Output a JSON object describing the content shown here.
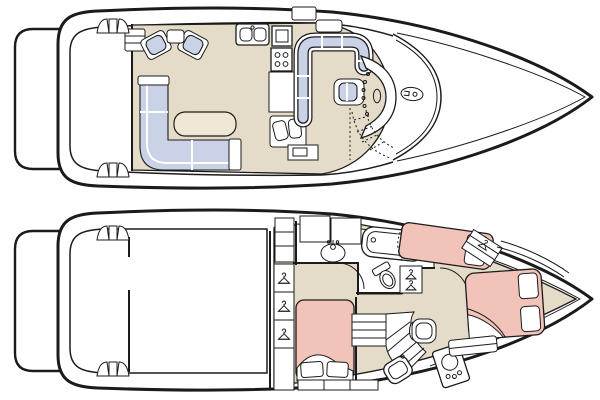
{
  "title": "Motor yacht two-deck floor plan",
  "colors": {
    "line": "#1b1b1b",
    "floor": "#e4dcc8",
    "cushion": "#c9d2e6",
    "bed": "#f2c3b9",
    "table": "#efe8d6",
    "paper": "#ffffff"
  },
  "decks": [
    {
      "label": "Main deck",
      "areas": [
        {
          "name": "swim-platform",
          "fixtures": []
        },
        {
          "name": "aft-cockpit",
          "fixtures": [
            "boarding-steps-port",
            "boarding-steps-starboard",
            "salon-entry-steps"
          ]
        },
        {
          "name": "salon",
          "fixtures": [
            "armchair-port",
            "armchair-starboard",
            "side-table",
            "l-shaped-sofa",
            "coffee-table",
            "bench-seat",
            "tv-cabinet"
          ]
        },
        {
          "name": "galley",
          "fixtures": [
            "double-sink",
            "refrigerator",
            "four-burner-stove",
            "counter"
          ]
        },
        {
          "name": "dinette",
          "fixtures": [
            "wraparound-booth",
            "deck-hatch"
          ]
        },
        {
          "name": "helm",
          "fixtures": [
            "helm-seat",
            "instrument-console",
            "steering-wheel",
            "windshield",
            "companionway-stairs",
            "foredeck-hatch"
          ]
        }
      ]
    },
    {
      "label": "Lower deck",
      "areas": [
        {
          "name": "swim-platform",
          "fixtures": []
        },
        {
          "name": "cockpit",
          "fixtures": [
            "boarding-steps-port",
            "boarding-steps-starboard",
            "transom-bulkhead"
          ]
        },
        {
          "name": "aft-stateroom",
          "fixtures": [
            "double-berth",
            "pillows",
            "turned-linen",
            "hanging-lockers",
            "settee"
          ]
        },
        {
          "name": "head",
          "fixtures": [
            "vanity-sink",
            "storage-cabinets",
            "bathtub",
            "toilet",
            "door-swing"
          ]
        },
        {
          "name": "mid-cabin",
          "fixtures": [
            "single-berth",
            "pillow",
            "privacy-curtain",
            "hanging-locker"
          ]
        },
        {
          "name": "passageway",
          "fixtures": [
            "curved-staircase",
            "vanity-stool",
            "shower-pan",
            "washer-dryer",
            "door-swing"
          ]
        },
        {
          "name": "forward-stateroom",
          "fixtures": [
            "island-berth",
            "pillows",
            "turned-linen",
            "hanging-locker",
            "foot-bench",
            "side-shelves"
          ]
        }
      ]
    }
  ]
}
